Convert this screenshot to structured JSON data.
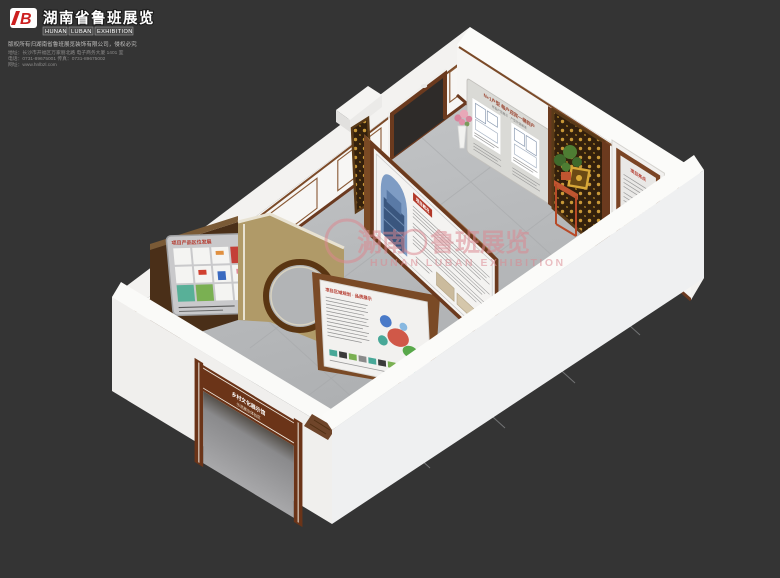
{
  "branding": {
    "logo_mark": "B",
    "company_cn": "湖南省鲁班展览",
    "company_en_words": [
      "HUNAN",
      "LUBAN",
      "EXHIBITION"
    ],
    "tagline": "版权所有归湖南省鲁班展览装饰有限公司，侵权必究",
    "address": "地址：长沙市开福区万家丽北路 电子商务大厦 1401 室",
    "phone": "电话：0731-89675001    传真：0731-89675002",
    "website": "网址：www.hnlbzl.com"
  },
  "watermark": {
    "cn_left": "湖南",
    "cn_right": "鲁班展览",
    "en": "HUNAN  LUBAN  EXHIBITION"
  },
  "room": {
    "plans_panel": {
      "title": "N+1户型 每户迎宾一梯到户",
      "subtitle": "样板户型展示 · 户型价值解读"
    },
    "right_panel": {
      "title": "项目亮点"
    },
    "grid_display": {
      "title": "项目产品区位发展"
    },
    "map_panel": {
      "title": "项目区域规划 · 品质展示"
    },
    "center_display": {
      "title": "项目概况"
    },
    "entrance": {
      "line1": "乡村文化展示馆",
      "line2": "示范展示体验区"
    }
  },
  "colors": {
    "background": "#343434",
    "wall_white": "#f4f3f1",
    "floor_gray": "#b7b9bb",
    "wood_brown": "#6b3a1e",
    "tan_wall": "#b09a68",
    "gold": "#c89838",
    "accent_red": "#b43a2e",
    "watermark_pink": "#dc8890"
  }
}
